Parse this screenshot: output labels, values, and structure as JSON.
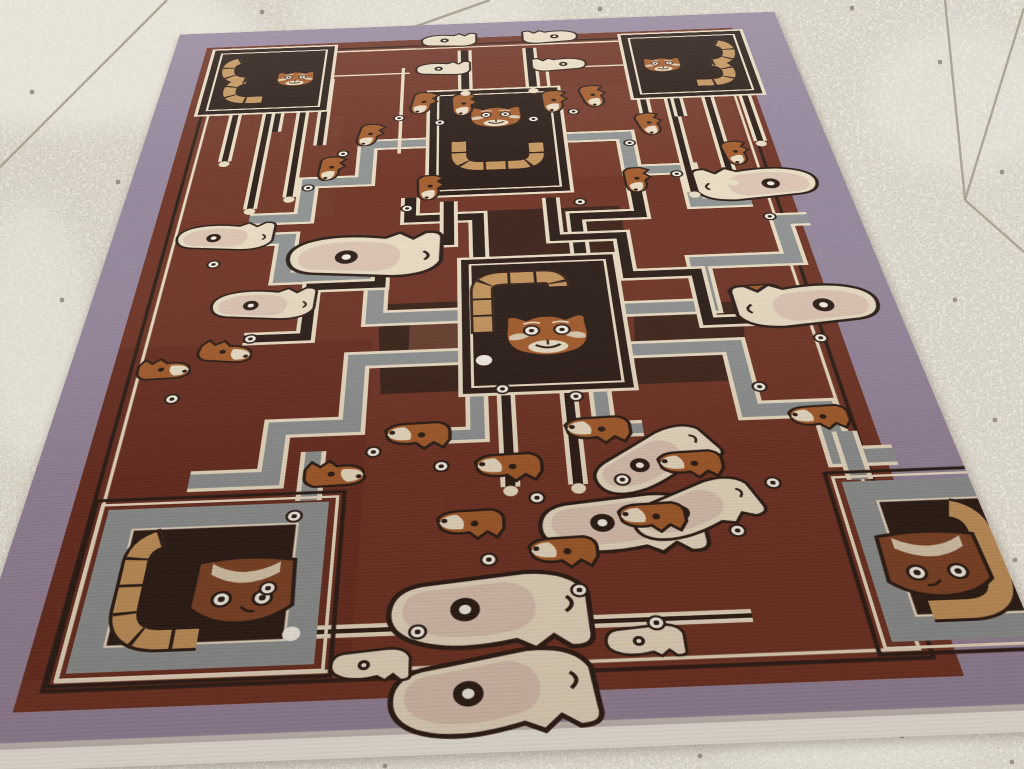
{
  "palette": {
    "mauve": "#95869b",
    "mauve2": "#84758a",
    "field": "#6e3425",
    "field2": "#7c4331",
    "dark": "#2b1d17",
    "darkbrown": "#38231a",
    "cream": "#e9dcc3",
    "cream2": "#d9c9ae",
    "white": "#f6f1e4",
    "gray": "#8e9291",
    "gray2": "#767a7c",
    "tan": "#c3945c",
    "orange": "#a25c2c",
    "brownmid": "#7d4527",
    "pink": "#dcc4b3",
    "floor": "#cfc8b6",
    "floor2": "#dad4c4",
    "grout": "#a39b8c",
    "stain": "#ece9de",
    "pebble": "#8a8173",
    "fringe": "#f3efe4"
  },
  "floor": {
    "grout_lines": [
      {
        "d": "M167,0 L0,167"
      },
      {
        "d": "M490,0 L414,27"
      },
      {
        "d": "M945,0 L965,200"
      },
      {
        "d": "M1024,8 L965,200"
      },
      {
        "d": "M965,200 L1024,252"
      }
    ],
    "stains": [
      {
        "cx": 70,
        "cy": 50,
        "rx": 190,
        "ry": 80,
        "o": 0.7
      },
      {
        "cx": 420,
        "cy": 15,
        "rx": 130,
        "ry": 38,
        "o": 0.5
      },
      {
        "cx": 30,
        "cy": 330,
        "rx": 60,
        "ry": 130,
        "o": 0.5
      },
      {
        "cx": 960,
        "cy": 100,
        "rx": 95,
        "ry": 75,
        "o": 0.45
      },
      {
        "cx": 850,
        "cy": 745,
        "rx": 130,
        "ry": 30,
        "o": 0.4
      },
      {
        "cx": 120,
        "cy": 600,
        "rx": 70,
        "ry": 90,
        "o": 0.35
      }
    ],
    "pebbles": [
      [
        118,
        182
      ],
      [
        62,
        300
      ],
      [
        32,
        92
      ],
      [
        940,
        62
      ],
      [
        1002,
        172
      ],
      [
        90,
        522
      ],
      [
        43,
        606
      ],
      [
        172,
        82
      ],
      [
        262,
        12
      ],
      [
        600,
        9
      ],
      [
        662,
        18
      ],
      [
        852,
        8
      ],
      [
        700,
        756
      ],
      [
        902,
        736
      ],
      [
        1012,
        762
      ],
      [
        385,
        766
      ],
      [
        955,
        300
      ],
      [
        995,
        420
      ],
      [
        1015,
        560
      ]
    ]
  },
  "rug": {
    "bands": [
      {
        "d": "M530,905 H410 V800 H270 V700 H135",
        "c": "gray",
        "w": 24
      },
      {
        "d": "M530,995 H390 V1125 H295 V1215 H195",
        "c": "gray",
        "w": 24
      },
      {
        "d": "M760,905 H880 V800 H1020 V700 H1062",
        "c": "gray",
        "w": 24
      },
      {
        "d": "M760,995 H900 V1125 H995 V1215 H1062",
        "c": "gray",
        "w": 24
      },
      {
        "d": "M490,435 H380 V545 H290 V645 H205",
        "c": "gray",
        "w": 22
      },
      {
        "d": "M700,435 H810 V545 H900 V645 H985",
        "c": "gray",
        "w": 22
      },
      {
        "d": "M560,770 V660 H455 V600",
        "c": "dark",
        "w": 18
      },
      {
        "d": "M710,770 V670 H810 V555",
        "c": "dark",
        "w": 18
      },
      {
        "d": "M515,615 V725 H415 V825 H316 V940 H230",
        "c": "dark",
        "w": 16
      },
      {
        "d": "M675,615 V725 H775 V825 H874 V940 H960",
        "c": "dark",
        "w": 16
      },
      {
        "d": "M545,110 V265",
        "c": "dark",
        "w": 14
      },
      {
        "d": "M665,110 V265",
        "c": "dark",
        "w": 14
      },
      {
        "d": "M589,1078 V1245",
        "c": "dark",
        "w": 12
      },
      {
        "d": "M671,1078 V1245",
        "c": "dark",
        "w": 12
      },
      {
        "d": "M551,1078 V1150 H505",
        "c": "gray",
        "w": 18
      },
      {
        "d": "M712,1078 V1150 H760",
        "c": "gray",
        "w": 18
      },
      {
        "d": "M345,1255 V1170",
        "c": "gray",
        "w": 20
      },
      {
        "d": "M1010,1255 V1170",
        "c": "gray",
        "w": 20
      },
      {
        "d": "M145,315 V470",
        "c": "dark",
        "w": 10
      },
      {
        "d": "M203,315 V615",
        "c": "dark",
        "w": 10
      },
      {
        "d": "M262,315 V585",
        "c": "dark",
        "w": 10
      },
      {
        "d": "M900,315 V615",
        "c": "dark",
        "w": 10
      },
      {
        "d": "M965,315 V585",
        "c": "dark",
        "w": 10
      },
      {
        "d": "M1030,315 V470",
        "c": "dark",
        "w": 10
      },
      {
        "d": "M299,200 V430",
        "c": "dark",
        "w": 10
      },
      {
        "d": "M853,200 V430",
        "c": "dark",
        "w": 10
      },
      {
        "d": "M219,200 V380",
        "c": "dark",
        "w": 10
      },
      {
        "d": "M911,200 V380",
        "c": "dark",
        "w": 10
      },
      {
        "d": "M345,1455 H845",
        "c": "dark",
        "w": 6
      },
      {
        "d": "M433,170 V466",
        "c": "cream",
        "w": 6
      },
      {
        "d": "M693,170 V466",
        "c": "cream",
        "w": 6
      },
      {
        "d": "M310,96 H455",
        "c": "cream",
        "w": 5
      },
      {
        "d": "M685,96 H830",
        "c": "cream",
        "w": 5
      },
      {
        "d": "M300,190 H445",
        "c": "cream",
        "w": 5
      },
      {
        "d": "M695,190 H840",
        "c": "cream",
        "w": 5
      }
    ],
    "patches": [
      {
        "pts": "775,898 930,898 904,1066 760,1066",
        "c": "#3a241b",
        "o": 0.9
      },
      {
        "pts": "414,873 527,873 531,1066 425,1066",
        "c": "#33211a",
        "o": 0.9
      },
      {
        "pts": "560,645 780,645 780,772 560,772",
        "c": "#342019",
        "o": 0.85
      },
      {
        "pts": "700,262 1005,262 1005,560 700,560",
        "c": "#7d4530",
        "o": 0.35
      },
      {
        "pts": "85,335 335,335 335,645 85,645",
        "c": "#7b4331",
        "o": 0.3
      },
      {
        "pts": "60,950 410,950 410,1505 60,1505",
        "c": "#5e291d",
        "o": 0.35
      },
      {
        "pts": "460,900 532,900 532,1012 460,1012",
        "c": "#86503a",
        "o": 0.6
      }
    ],
    "animals": [
      {
        "t": "llama",
        "x": 517,
        "y": 75,
        "r": 0,
        "f": 1,
        "s": 1.15
      },
      {
        "t": "llama",
        "x": 705,
        "y": 75,
        "r": 0,
        "f": 0,
        "s": 1.15
      },
      {
        "t": "llama",
        "x": 506,
        "y": 185,
        "r": 0,
        "f": 1,
        "s": 1.1
      },
      {
        "t": "llama",
        "x": 715,
        "y": 185,
        "r": 0,
        "f": 0,
        "s": 1.1
      },
      {
        "t": "fox",
        "x": 465,
        "y": 300,
        "r": 100,
        "f": 0,
        "s": 1.1
      },
      {
        "t": "fox",
        "x": 535,
        "y": 312,
        "r": 90,
        "f": 0,
        "s": 1.1
      },
      {
        "t": "fox",
        "x": 692,
        "y": 312,
        "r": 90,
        "f": 0,
        "s": 1.1
      },
      {
        "t": "fox",
        "x": 762,
        "y": 300,
        "r": 80,
        "f": 0,
        "s": 1.1
      },
      {
        "t": "fox",
        "x": 376,
        "y": 402,
        "r": 100,
        "f": 0,
        "s": 1.05
      },
      {
        "t": "fox",
        "x": 849,
        "y": 402,
        "r": 80,
        "f": 0,
        "s": 1.05
      },
      {
        "t": "fox",
        "x": 317,
        "y": 504,
        "r": 95,
        "f": 0,
        "s": 1.05
      },
      {
        "t": "fox",
        "x": 479,
        "y": 573,
        "r": 90,
        "f": 0,
        "s": 1.05
      },
      {
        "t": "fox",
        "x": 978,
        "y": 504,
        "r": 85,
        "f": 0,
        "s": 1.05
      },
      {
        "t": "fox",
        "x": 809,
        "y": 573,
        "r": 90,
        "f": 0,
        "s": 1.05
      },
      {
        "t": "fox",
        "x": 208,
        "y": 973,
        "r": 10,
        "f": 0,
        "s": 1.1
      },
      {
        "t": "fox",
        "x": 374,
        "y": 1218,
        "r": 0,
        "f": 0,
        "s": 1.1
      },
      {
        "t": "fox",
        "x": 130,
        "y": 1005,
        "r": 0,
        "f": 0,
        "s": 1.05
      },
      {
        "t": "fox",
        "x": 950,
        "y": 875,
        "r": 180,
        "f": 0,
        "s": 1.1
      },
      {
        "t": "fox",
        "x": 985,
        "y": 1135,
        "r": 180,
        "f": 0,
        "s": 1.1
      },
      {
        "t": "big",
        "x": 174,
        "y": 700,
        "r": 0,
        "f": 1,
        "s": 1.0
      },
      {
        "t": "big",
        "x": 250,
        "y": 873,
        "r": 0,
        "f": 1,
        "s": 1.0
      },
      {
        "t": "big",
        "x": 390,
        "y": 768,
        "r": 0,
        "f": 1,
        "s": 1.55
      },
      {
        "t": "big",
        "x": 1000,
        "y": 610,
        "r": 0,
        "f": 0,
        "s": 1.3
      },
      {
        "t": "big",
        "x": 1015,
        "y": 925,
        "r": 0,
        "f": 0,
        "s": 1.35
      },
      {
        "t": "big",
        "x": 559,
        "y": 1418,
        "r": 180,
        "f": 0,
        "s": 1.5
      },
      {
        "t": "big",
        "x": 718,
        "y": 1298,
        "r": 180,
        "f": 0,
        "s": 1.3
      },
      {
        "t": "big",
        "x": 559,
        "y": 1528,
        "r": 175,
        "f": 0,
        "s": 1.45
      },
      {
        "t": "llama",
        "x": 431,
        "y": 1495,
        "r": 180,
        "f": 0,
        "s": 0.95
      },
      {
        "t": "llama",
        "x": 726,
        "y": 1477,
        "r": 180,
        "f": 0,
        "s": 0.95
      },
      {
        "t": "big",
        "x": 761,
        "y": 1198,
        "r": 150,
        "f": 0,
        "s": 1.1
      },
      {
        "t": "big",
        "x": 802,
        "y": 1283,
        "r": 160,
        "f": 0,
        "s": 1.05
      },
      {
        "t": "fox",
        "x": 475,
        "y": 1140,
        "r": 180,
        "f": 0,
        "s": 1.2
      },
      {
        "t": "fox",
        "x": 588,
        "y": 1203,
        "r": 180,
        "f": 0,
        "s": 1.2
      },
      {
        "t": "fox",
        "x": 703,
        "y": 1142,
        "r": 180,
        "f": 0,
        "s": 1.2
      },
      {
        "t": "fox",
        "x": 811,
        "y": 1210,
        "r": 180,
        "f": 0,
        "s": 1.15
      },
      {
        "t": "fox",
        "x": 540,
        "y": 1296,
        "r": 180,
        "f": 0,
        "s": 1.15
      },
      {
        "t": "fox",
        "x": 646,
        "y": 1345,
        "r": 180,
        "f": 0,
        "s": 1.15
      },
      {
        "t": "fox",
        "x": 754,
        "y": 1296,
        "r": 180,
        "f": 0,
        "s": 1.15
      }
    ],
    "rosettes": [
      [
        430,
        350
      ],
      [
        500,
        370
      ],
      [
        660,
        370
      ],
      [
        730,
        350
      ],
      [
        340,
        460
      ],
      [
        815,
        460
      ],
      [
        290,
        560
      ],
      [
        450,
        630
      ],
      [
        720,
        630
      ],
      [
        880,
        560
      ],
      [
        165,
        760
      ],
      [
        240,
        940
      ],
      [
        150,
        1060
      ],
      [
        330,
        1280
      ],
      [
        420,
        1175
      ],
      [
        1005,
        690
      ],
      [
        1020,
        985
      ],
      [
        920,
        1080
      ],
      [
        905,
        1255
      ],
      [
        505,
        1205
      ],
      [
        620,
        1265
      ],
      [
        725,
        1240
      ],
      [
        560,
        1360
      ],
      [
        660,
        1410
      ],
      [
        480,
        1460
      ],
      [
        740,
        1460
      ],
      [
        310,
        1390
      ],
      [
        850,
        1330
      ],
      [
        585,
        1065
      ],
      [
        680,
        1085
      ]
    ],
    "feet": [
      [
        589,
        1252
      ],
      [
        671,
        1252
      ],
      [
        145,
        478
      ],
      [
        203,
        622
      ],
      [
        262,
        592
      ],
      [
        900,
        622
      ],
      [
        965,
        592
      ],
      [
        1030,
        478
      ],
      [
        545,
        272
      ],
      [
        665,
        272
      ]
    ]
  }
}
